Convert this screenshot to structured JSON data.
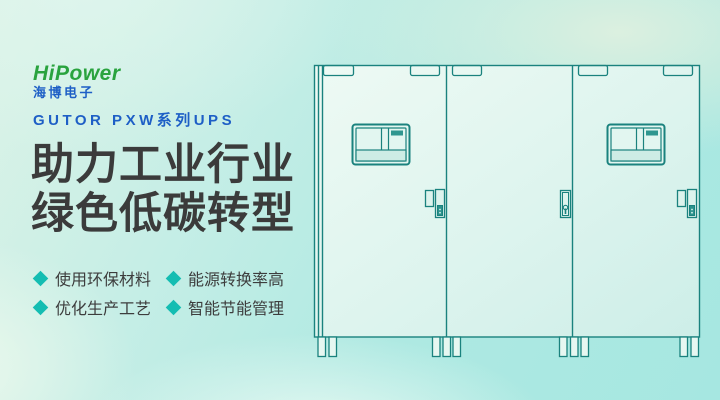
{
  "brand": {
    "name": "HiPower",
    "chinese_name": "海博电子"
  },
  "header": {
    "series": "GUTOR PXW系列UPS"
  },
  "title": {
    "line1": "助力工业行业",
    "line2": "绿色低碳转型"
  },
  "features": [
    {
      "label": "使用环保材料"
    },
    {
      "label": "能源转换率高"
    },
    {
      "label": "优化生产工艺"
    },
    {
      "label": "智能节能管理"
    }
  ],
  "illustration": {
    "name": "ups-cabinet-lineup",
    "cabinet_count": 3
  },
  "colors": {
    "accent_teal": "#14bdb2",
    "brand_green": "#29a33e",
    "brand_blue": "#1e5fc6",
    "title_gray": "#3b3b3b",
    "cabinet_line": "#1a827e",
    "bg_mint": "#dcf3e7",
    "bg_aqua": "#a6e7e1"
  }
}
